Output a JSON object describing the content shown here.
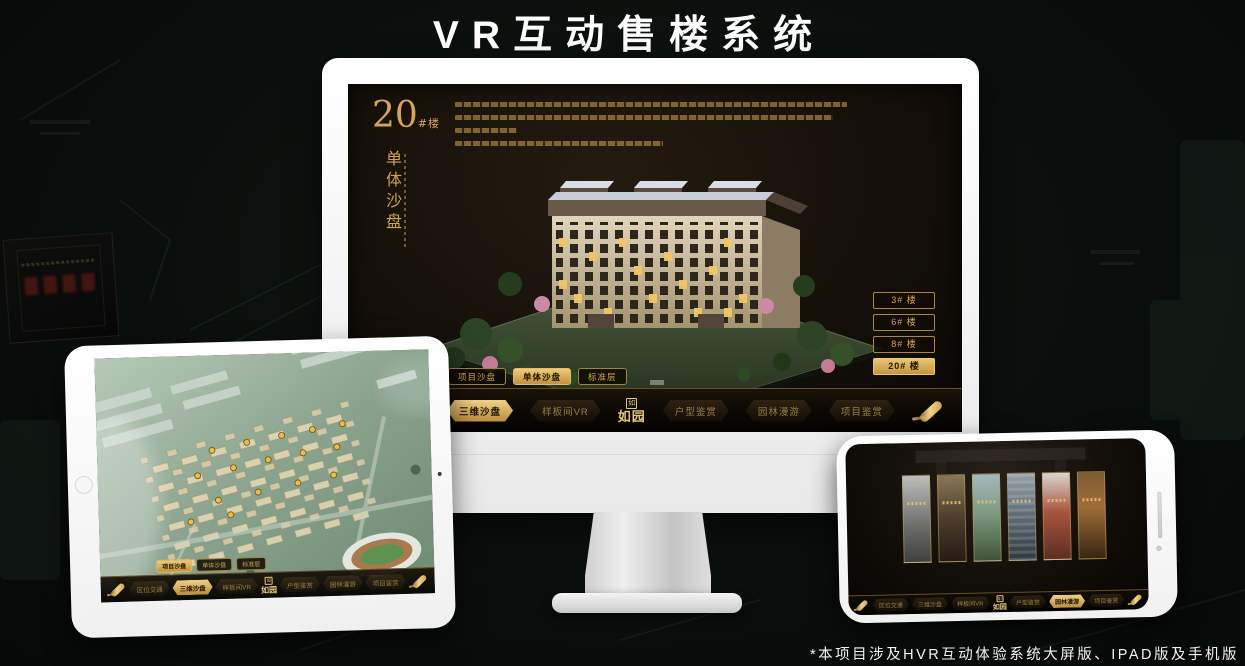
{
  "page": {
    "title": "VR互动售楼系统",
    "footnote": "*本项目涉及HVR互动体验系统大屏版、IPAD版及手机版"
  },
  "brand": {
    "name": "如园",
    "seal": "如",
    "gold": "#d2a755"
  },
  "monitor_app": {
    "building_number": "20",
    "building_unit": "#楼",
    "section_title": "单体沙盘",
    "building_buttons": [
      {
        "label": "3# 楼",
        "active": false
      },
      {
        "label": "6# 楼",
        "active": false
      },
      {
        "label": "8# 楼",
        "active": false
      },
      {
        "label": "20# 楼",
        "active": true
      }
    ],
    "mode_tabs": [
      {
        "label": "项目沙盘",
        "active": false
      },
      {
        "label": "单体沙盘",
        "active": true
      },
      {
        "label": "标准层",
        "active": false
      }
    ],
    "nav": {
      "items": [
        {
          "label": "区位交通",
          "active": false
        },
        {
          "label": "三维沙盘",
          "active": true
        },
        {
          "label": "样板间VR",
          "active": false
        },
        {
          "label": "户型鉴赏",
          "active": false
        },
        {
          "label": "园林漫游",
          "active": false
        },
        {
          "label": "项目鉴赏",
          "active": false
        }
      ]
    }
  },
  "tablet_app": {
    "mode_tabs": [
      {
        "label": "项目沙盘",
        "active": true
      },
      {
        "label": "单体沙盘",
        "active": false
      },
      {
        "label": "标准层",
        "active": false
      }
    ],
    "nav": {
      "items": [
        {
          "label": "区位交通",
          "active": false
        },
        {
          "label": "三维沙盘",
          "active": true
        },
        {
          "label": "样板间VR",
          "active": false
        },
        {
          "label": "户型鉴赏",
          "active": false
        },
        {
          "label": "园林漫游",
          "active": false
        },
        {
          "label": "项目鉴赏",
          "active": false
        }
      ]
    }
  },
  "phone_app": {
    "nav": {
      "items": [
        {
          "label": "区位交通",
          "active": false
        },
        {
          "label": "三维沙盘",
          "active": false
        },
        {
          "label": "样板间VR",
          "active": false
        },
        {
          "label": "户型鉴赏",
          "active": false
        },
        {
          "label": "园林漫游",
          "active": true
        },
        {
          "label": "项目鉴赏",
          "active": false
        }
      ]
    }
  }
}
